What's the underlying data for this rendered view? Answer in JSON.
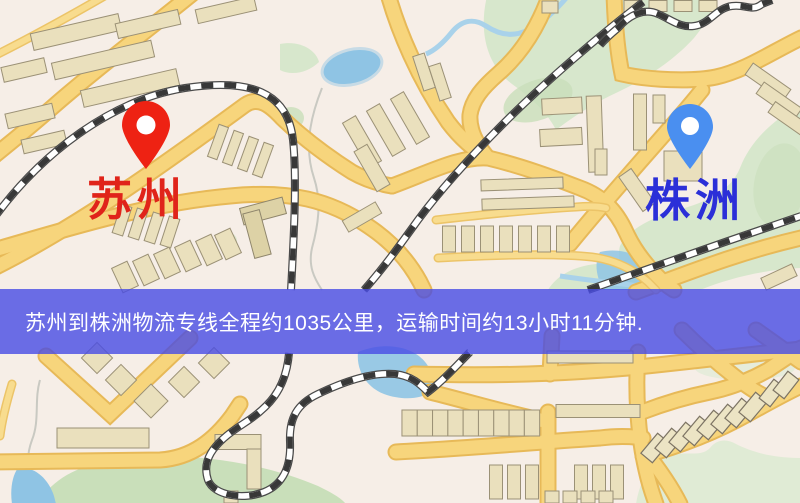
{
  "banner": {
    "text": "苏州到株洲物流专线全程约1035公里，运输时间约13小时11分钟.",
    "background_rgba": "rgba(71,75,229,0.8)",
    "text_color": "#ffffff"
  },
  "route_info": {
    "origin": "苏州",
    "destination": "株洲",
    "distance_text": "约1035公里",
    "duration_text": "约13小时11分钟"
  },
  "markers": {
    "origin": {
      "label": "苏州",
      "label_color": "#e0241a",
      "pin_color": "#ee2213",
      "icon": "map-pin-icon"
    },
    "destination": {
      "label": "株洲",
      "label_color": "#2b2fd8",
      "pin_color": "#4a8ff0",
      "icon": "map-pin-icon"
    }
  },
  "map_palette": {
    "background": "#f6eee7",
    "road": "#f7d57c",
    "building": "#eae0bd",
    "park_green": "#d7e7cc",
    "water_blue": "#8fc4e4",
    "railway_dark": "#383838"
  }
}
